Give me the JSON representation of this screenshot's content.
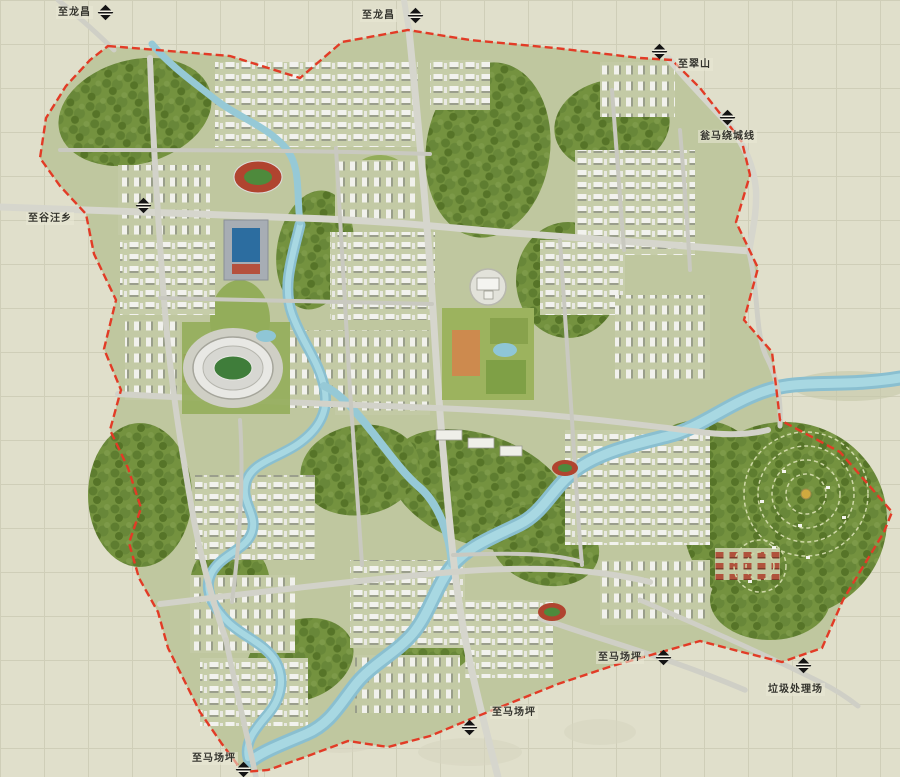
{
  "map": {
    "labels": [
      {
        "id": "north-west-road",
        "text": "至龙昌",
        "icon": "direction-marker"
      },
      {
        "id": "north-road",
        "text": "至龙昌",
        "icon": "direction-marker"
      },
      {
        "id": "north-east-road",
        "text": "至翠山",
        "icon": "direction-marker"
      },
      {
        "id": "east-highway",
        "text": "瓮马绕城线",
        "icon": "direction-marker"
      },
      {
        "id": "west-road",
        "text": "至谷汪乡",
        "icon": "direction-marker"
      },
      {
        "id": "south-east-road",
        "text": "至马场坪",
        "icon": "direction-marker"
      },
      {
        "id": "landfill-road",
        "text": "垃圾处理场",
        "icon": "direction-marker"
      },
      {
        "id": "south-road",
        "text": "至马场坪",
        "icon": "direction-marker"
      },
      {
        "id": "south-west-road",
        "text": "至马场坪",
        "icon": "direction-marker"
      }
    ],
    "colors": {
      "boundary": "#e23b26",
      "river": "#9ccfdb",
      "forest": "#74923f",
      "lawn": "#93ad5a",
      "road": "#d6d6cd",
      "background": "#e0dfcb",
      "track_red": "#b0442f",
      "pool_blue": "#2c6da0"
    }
  }
}
